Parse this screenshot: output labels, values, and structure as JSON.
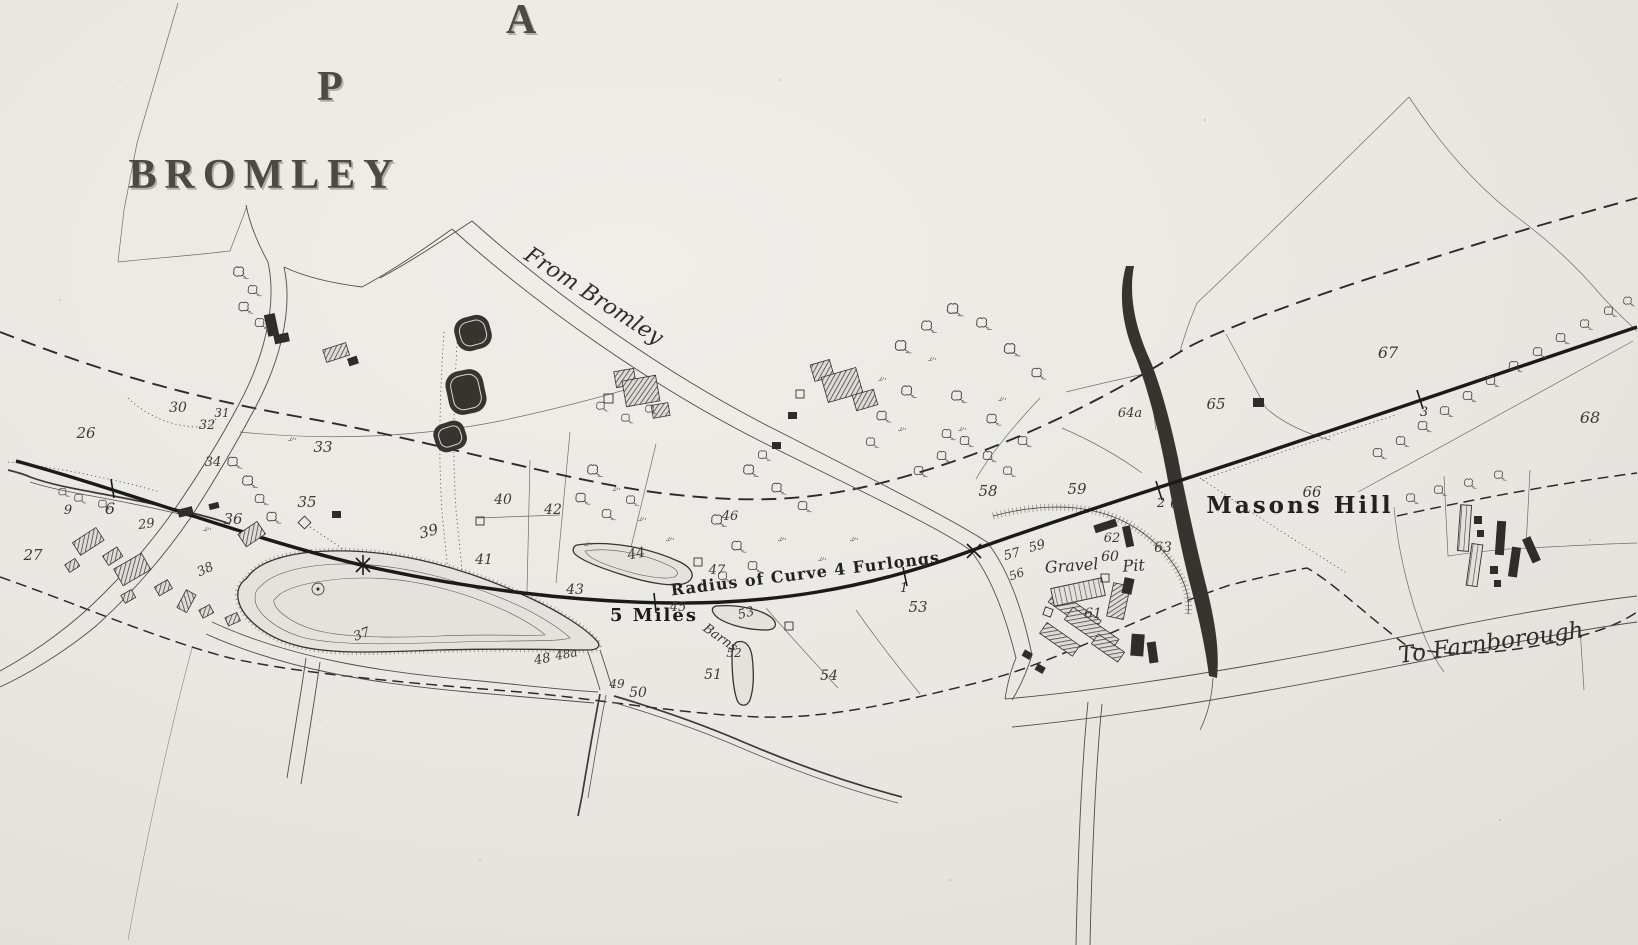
{
  "map": {
    "labels": [
      {
        "name": "map-letter-a",
        "text": "A",
        "x": 521,
        "y": 33,
        "fs": 42,
        "cls": "display",
        "shadow": true
      },
      {
        "name": "map-letter-p",
        "text": "P",
        "x": 330,
        "y": 100,
        "fs": 42,
        "cls": "display",
        "shadow": true
      },
      {
        "name": "label-bromley",
        "text": "BROMLEY",
        "x": 265,
        "y": 188,
        "fs": 42,
        "cls": "display",
        "ls": 8,
        "shadow": true
      },
      {
        "name": "label-from-bromley",
        "text": "From Bromley",
        "x": 590,
        "y": 302,
        "fs": 22,
        "cls": "script",
        "rot": 33
      },
      {
        "name": "label-to-farnborough",
        "text": "To Farnborough",
        "x": 1492,
        "y": 650,
        "fs": 23,
        "cls": "script",
        "rot": -8
      },
      {
        "name": "label-radius-of-curve",
        "text": "Radius of Curve 4 Furlongs",
        "x": 806,
        "y": 579,
        "fs": 16,
        "cls": "railnote",
        "rot": -7
      },
      {
        "name": "label-5-miles",
        "text": "5 Miles",
        "x": 654,
        "y": 621,
        "fs": 18,
        "cls": "railbold"
      },
      {
        "name": "label-masons-hill",
        "text": "Masons Hill",
        "x": 1300,
        "y": 513,
        "fs": 23,
        "cls": "place",
        "ls": 3
      },
      {
        "name": "label-gravel",
        "text": "Gravel",
        "x": 1072,
        "y": 571,
        "fs": 16,
        "cls": "italic",
        "rot": -4
      },
      {
        "name": "label-gravel-pit-60",
        "text": "60",
        "x": 1110,
        "y": 561,
        "fs": 14,
        "cls": "italic"
      },
      {
        "name": "label-pit",
        "text": "Pit",
        "x": 1134,
        "y": 571,
        "fs": 16,
        "cls": "italic",
        "rot": -4
      },
      {
        "name": "label-barns",
        "text": "Barns",
        "x": 718,
        "y": 641,
        "fs": 13,
        "cls": "italic",
        "rot": 35
      },
      {
        "name": "railway-chain-9",
        "text": "9",
        "x": 68,
        "y": 514,
        "fs": 13,
        "cls": "ticklbl"
      },
      {
        "name": "railway-chain-6",
        "text": "6",
        "x": 110,
        "y": 514,
        "fs": 16,
        "cls": "ticklbl"
      },
      {
        "name": "railway-chain-1",
        "text": "1",
        "x": 904,
        "y": 592,
        "fs": 13,
        "cls": "ticklbl"
      },
      {
        "name": "railway-chain-2",
        "text": "2",
        "x": 1161,
        "y": 507,
        "fs": 13,
        "cls": "ticklbl"
      },
      {
        "name": "railway-chain-3",
        "text": "3",
        "x": 1424,
        "y": 416,
        "fs": 13,
        "cls": "ticklbl"
      },
      {
        "name": "parcel-26",
        "text": "26",
        "x": 86,
        "y": 438,
        "fs": 15,
        "cls": "parcel"
      },
      {
        "name": "parcel-27",
        "text": "27",
        "x": 33,
        "y": 560,
        "fs": 15,
        "cls": "parcel"
      },
      {
        "name": "parcel-29",
        "text": "29",
        "x": 147,
        "y": 528,
        "fs": 13,
        "cls": "parcel",
        "rot": -8
      },
      {
        "name": "parcel-30",
        "text": "30",
        "x": 178,
        "y": 412,
        "fs": 14,
        "cls": "parcel"
      },
      {
        "name": "parcel-31",
        "text": "31",
        "x": 222,
        "y": 417,
        "fs": 12,
        "cls": "parcel"
      },
      {
        "name": "parcel-32",
        "text": "32",
        "x": 207,
        "y": 429,
        "fs": 13,
        "cls": "parcel"
      },
      {
        "name": "parcel-33",
        "text": "33",
        "x": 323,
        "y": 452,
        "fs": 15,
        "cls": "parcel"
      },
      {
        "name": "parcel-34",
        "text": "34",
        "x": 213,
        "y": 466,
        "fs": 13,
        "cls": "parcel"
      },
      {
        "name": "parcel-35",
        "text": "35",
        "x": 307,
        "y": 507,
        "fs": 15,
        "cls": "parcel"
      },
      {
        "name": "parcel-36",
        "text": "36",
        "x": 233,
        "y": 524,
        "fs": 15,
        "cls": "parcel"
      },
      {
        "name": "parcel-37",
        "text": "37",
        "x": 363,
        "y": 638,
        "fs": 13,
        "cls": "parcel",
        "rot": -20
      },
      {
        "name": "parcel-38",
        "text": "38",
        "x": 207,
        "y": 573,
        "fs": 13,
        "cls": "parcel",
        "rot": -25
      },
      {
        "name": "parcel-39",
        "text": "39",
        "x": 430,
        "y": 536,
        "fs": 15,
        "cls": "parcel",
        "rot": -15
      },
      {
        "name": "parcel-40",
        "text": "40",
        "x": 503,
        "y": 504,
        "fs": 14,
        "cls": "parcel"
      },
      {
        "name": "parcel-41",
        "text": "41",
        "x": 484,
        "y": 564,
        "fs": 14,
        "cls": "parcel"
      },
      {
        "name": "parcel-42",
        "text": "42",
        "x": 553,
        "y": 514,
        "fs": 14,
        "cls": "parcel"
      },
      {
        "name": "parcel-43",
        "text": "43",
        "x": 575,
        "y": 594,
        "fs": 14,
        "cls": "parcel"
      },
      {
        "name": "parcel-44",
        "text": "44",
        "x": 637,
        "y": 558,
        "fs": 14,
        "cls": "parcel",
        "rot": -10
      },
      {
        "name": "parcel-45",
        "text": "45",
        "x": 678,
        "y": 611,
        "fs": 13,
        "cls": "parcel"
      },
      {
        "name": "parcel-46",
        "text": "46",
        "x": 730,
        "y": 520,
        "fs": 13,
        "cls": "parcel"
      },
      {
        "name": "parcel-47",
        "text": "47",
        "x": 717,
        "y": 574,
        "fs": 13,
        "cls": "parcel"
      },
      {
        "name": "parcel-48",
        "text": "48",
        "x": 543,
        "y": 663,
        "fs": 13,
        "cls": "parcel",
        "rot": -10
      },
      {
        "name": "parcel-48a",
        "text": "48a",
        "x": 567,
        "y": 658,
        "fs": 12,
        "cls": "parcel",
        "rot": -10
      },
      {
        "name": "parcel-49",
        "text": "49",
        "x": 617,
        "y": 688,
        "fs": 12,
        "cls": "parcel"
      },
      {
        "name": "parcel-50",
        "text": "50",
        "x": 638,
        "y": 697,
        "fs": 14,
        "cls": "parcel"
      },
      {
        "name": "parcel-51",
        "text": "51",
        "x": 713,
        "y": 679,
        "fs": 14,
        "cls": "parcel"
      },
      {
        "name": "parcel-52",
        "text": "52",
        "x": 734,
        "y": 657,
        "fs": 12,
        "cls": "parcel"
      },
      {
        "name": "parcel-53-barn",
        "text": "53",
        "x": 747,
        "y": 617,
        "fs": 13,
        "cls": "parcel",
        "rot": -15
      },
      {
        "name": "parcel-53",
        "text": "53",
        "x": 918,
        "y": 612,
        "fs": 15,
        "cls": "parcel"
      },
      {
        "name": "parcel-54",
        "text": "54",
        "x": 829,
        "y": 680,
        "fs": 14,
        "cls": "parcel"
      },
      {
        "name": "parcel-56",
        "text": "56",
        "x": 1018,
        "y": 578,
        "fs": 12,
        "cls": "parcel",
        "rot": -20
      },
      {
        "name": "parcel-57",
        "text": "57",
        "x": 1013,
        "y": 558,
        "fs": 13,
        "cls": "parcel",
        "rot": -15
      },
      {
        "name": "parcel-58",
        "text": "58",
        "x": 988,
        "y": 496,
        "fs": 15,
        "cls": "parcel"
      },
      {
        "name": "parcel-59-small",
        "text": "59",
        "x": 1038,
        "y": 550,
        "fs": 13,
        "cls": "parcel",
        "rot": -15
      },
      {
        "name": "parcel-59",
        "text": "59",
        "x": 1077,
        "y": 494,
        "fs": 15,
        "cls": "parcel"
      },
      {
        "name": "parcel-61",
        "text": "61",
        "x": 1093,
        "y": 618,
        "fs": 14,
        "cls": "parcel"
      },
      {
        "name": "parcel-62",
        "text": "62",
        "x": 1112,
        "y": 542,
        "fs": 13,
        "cls": "parcel"
      },
      {
        "name": "parcel-63",
        "text": "63",
        "x": 1163,
        "y": 552,
        "fs": 14,
        "cls": "parcel"
      },
      {
        "name": "parcel-64",
        "text": "64",
        "x": 1179,
        "y": 508,
        "fs": 14,
        "cls": "parcel"
      },
      {
        "name": "parcel-64a",
        "text": "64a",
        "x": 1130,
        "y": 417,
        "fs": 13,
        "cls": "parcel"
      },
      {
        "name": "parcel-65",
        "text": "65",
        "x": 1216,
        "y": 409,
        "fs": 15,
        "cls": "parcel"
      },
      {
        "name": "parcel-66",
        "text": "66",
        "x": 1312,
        "y": 497,
        "fs": 15,
        "cls": "parcel"
      },
      {
        "name": "parcel-67",
        "text": "67",
        "x": 1388,
        "y": 358,
        "fs": 16,
        "cls": "parcel"
      },
      {
        "name": "parcel-68",
        "text": "68",
        "x": 1590,
        "y": 423,
        "fs": 16,
        "cls": "parcel"
      }
    ],
    "colors": {
      "paper": "#e9e7e1",
      "ink": "#2b2a27",
      "hairline": "#6e6c66",
      "railway": "#1b1a18"
    }
  }
}
